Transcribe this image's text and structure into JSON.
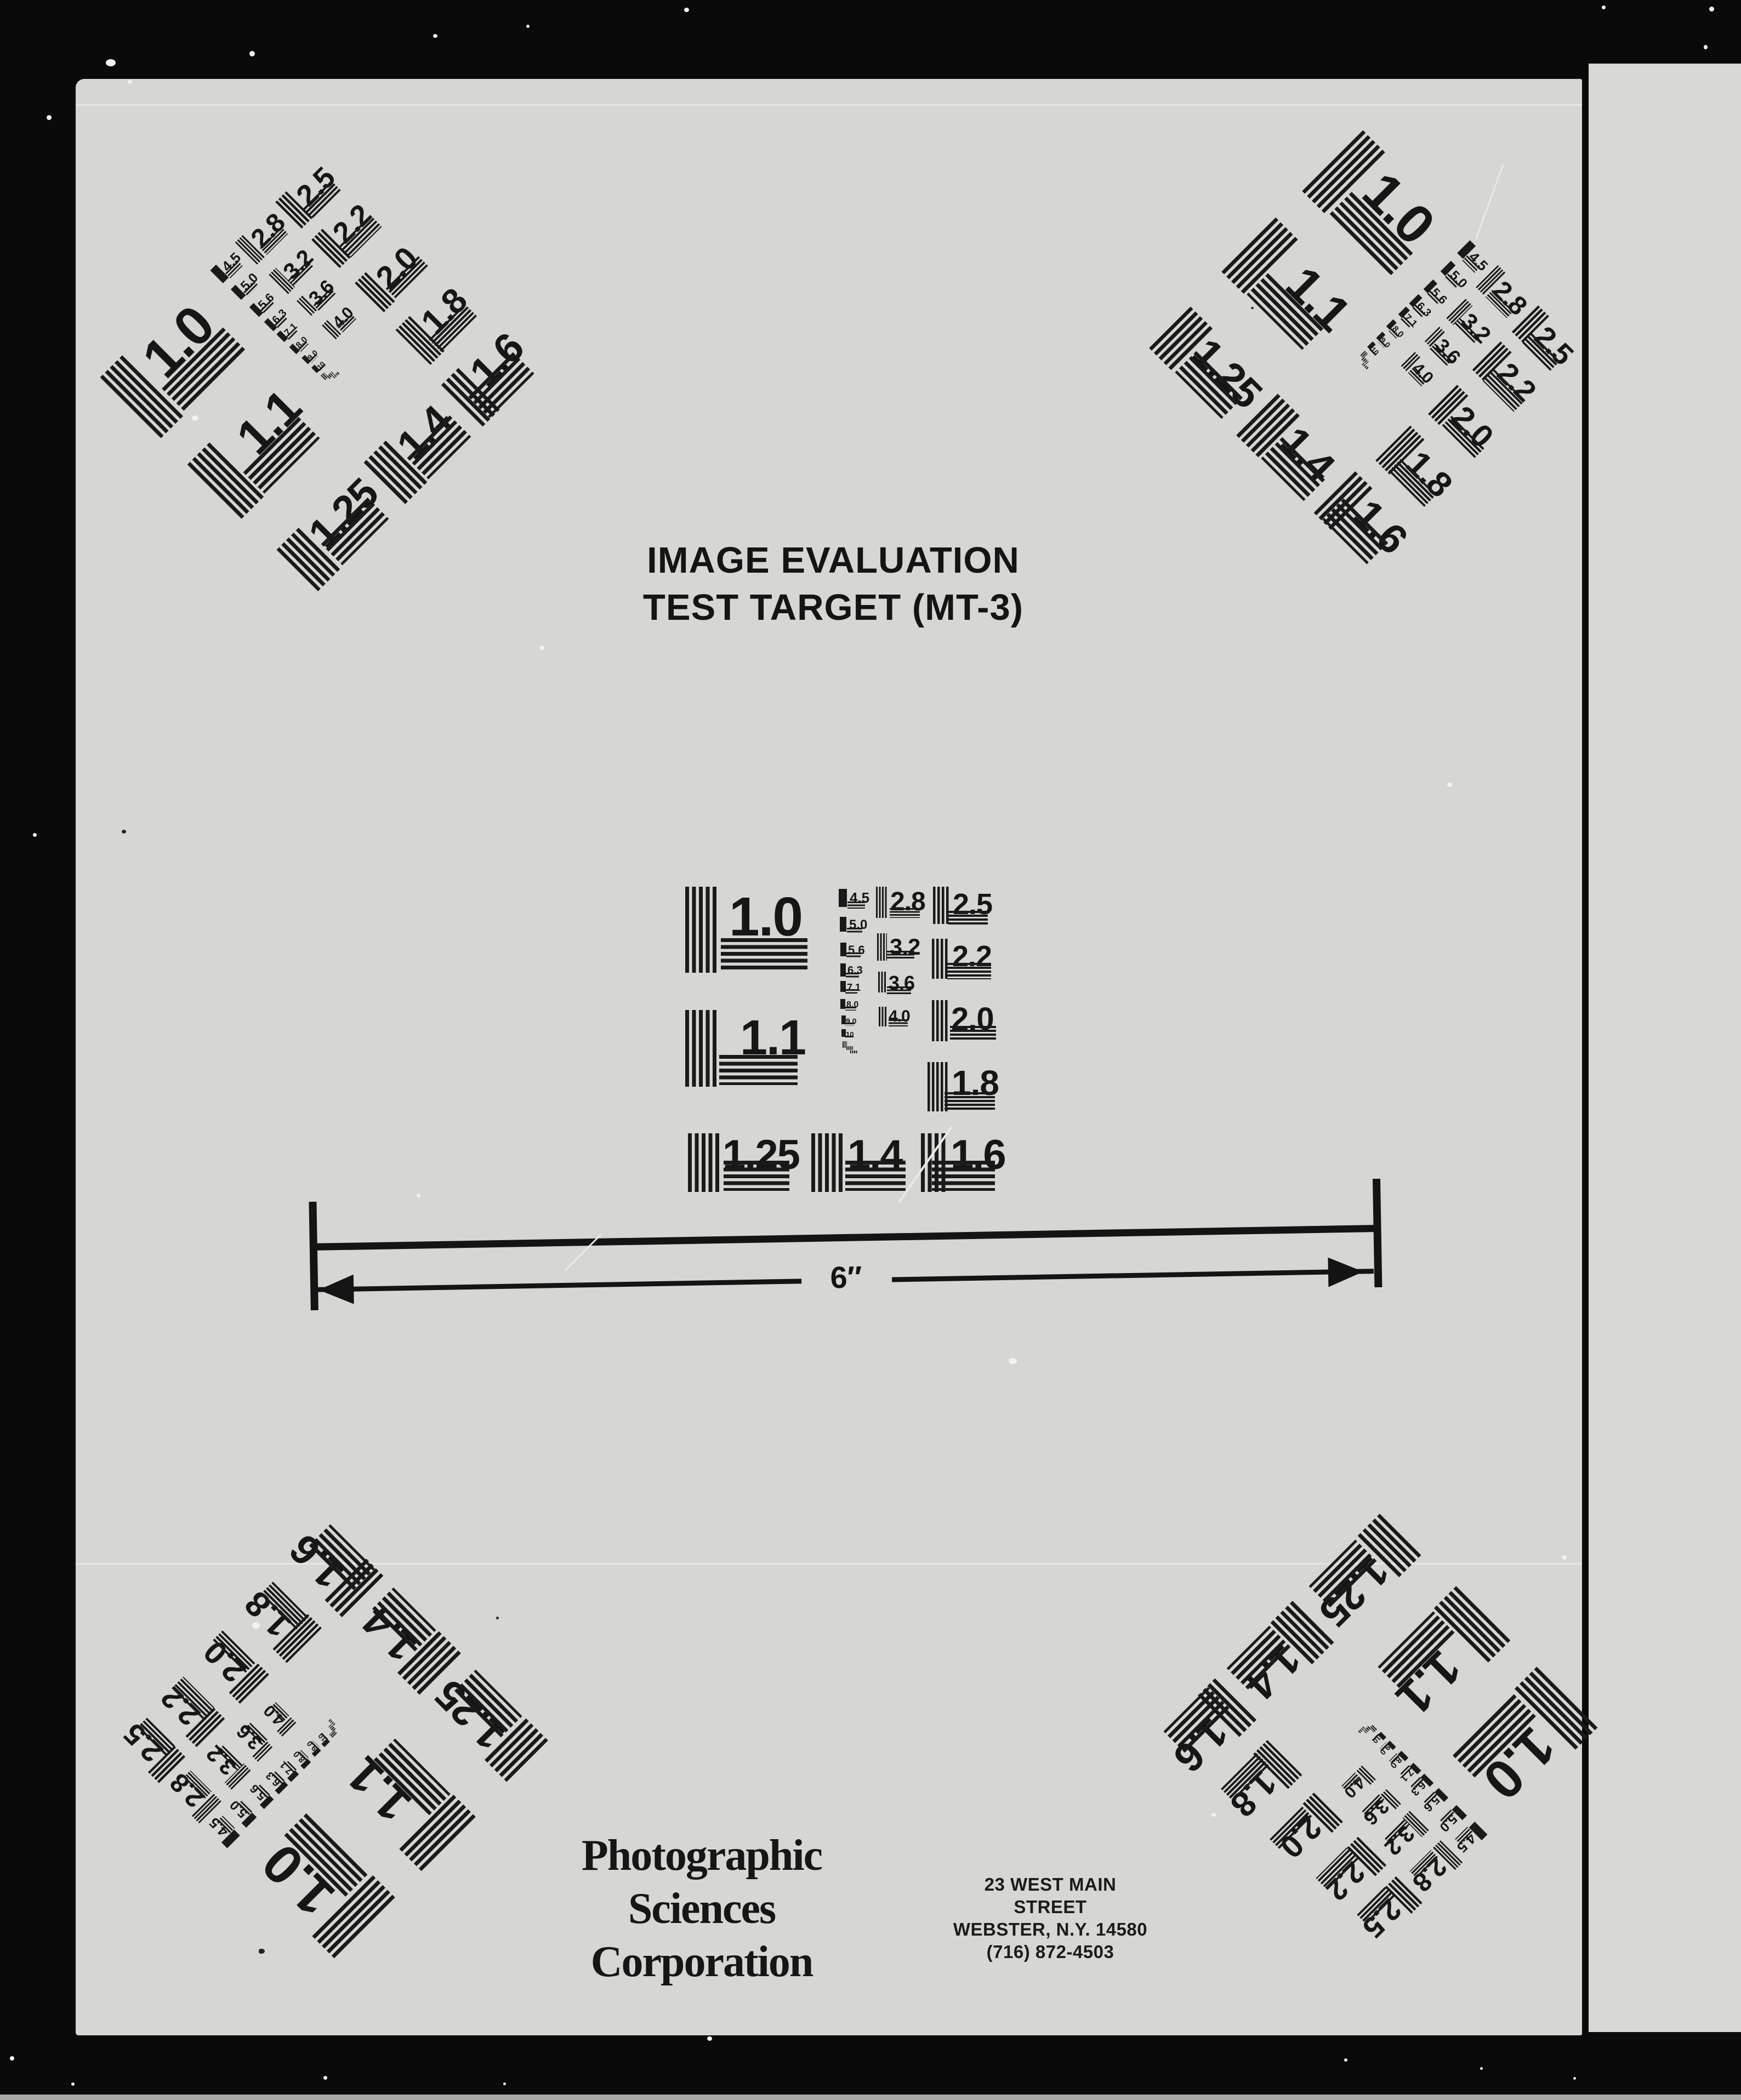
{
  "document": {
    "title_line1": "IMAGE EVALUATION",
    "title_line2": "TEST TARGET (MT-3)",
    "scale_label": "6″",
    "company_line1": "Photographic",
    "company_line2": "Sciences",
    "company_line3": "Corporation",
    "address_line1": "23 WEST MAIN STREET",
    "address_line2": "WEBSTER, N.Y. 14580",
    "address_line3": "(716) 872-4503"
  },
  "target": {
    "big": [
      "1.0",
      "1.1",
      "1.25",
      "1.4",
      "1.6"
    ],
    "right_column": [
      "2.5",
      "2.2",
      "2.0",
      "1.8"
    ],
    "mid_column": [
      "2.8",
      "3.2",
      "3.6",
      "4.0"
    ],
    "tiny_column": [
      "4.5",
      "5.0",
      "5.6",
      "6.3",
      "7.1",
      "8.0",
      "9.0",
      "10"
    ]
  },
  "colors": {
    "ink": "#1a1a1a",
    "paper": "#d6d6d3",
    "paper_strip": "#d8d8d5",
    "background": "#0a0a0a"
  }
}
